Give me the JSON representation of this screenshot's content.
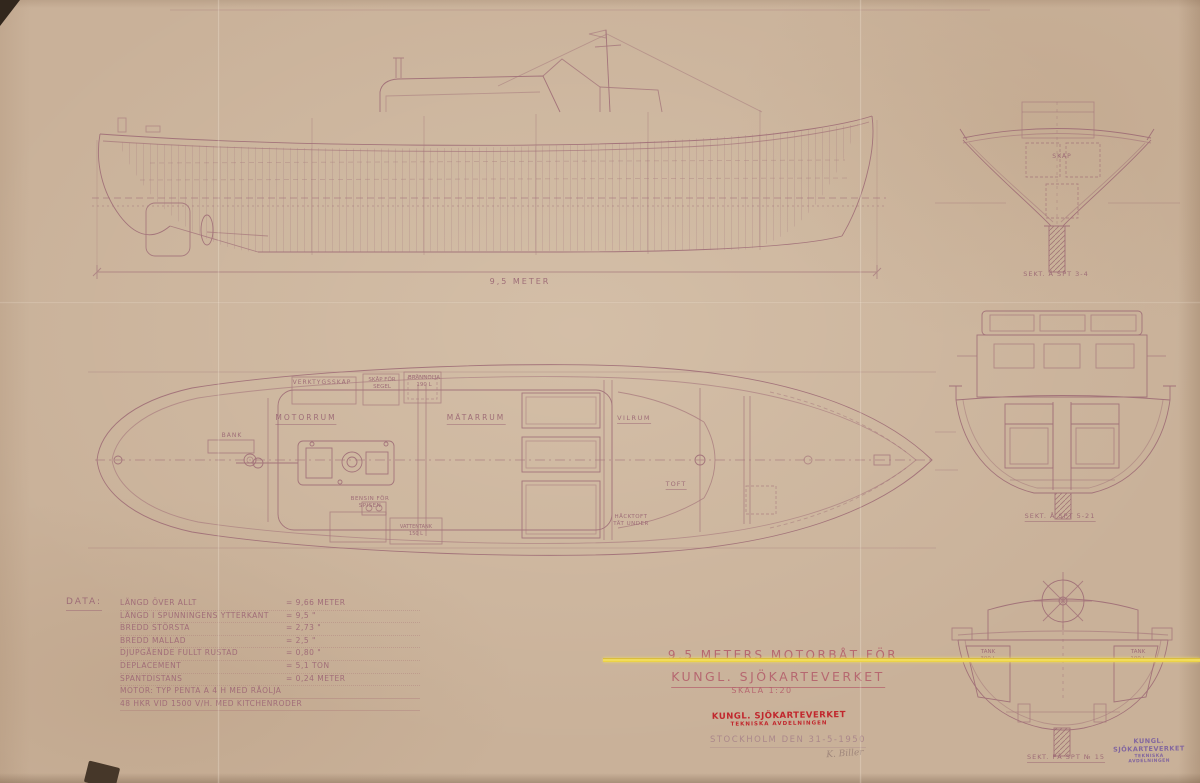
{
  "title_block": {
    "line1": "9,5 METERS MOTORBÅT FÖR",
    "line2": "KUNGL. SJÖKARTEVERKET",
    "scale": "SKALA 1:20"
  },
  "date_line": "STOCKHOLM DEN 31-5-1950",
  "signature": "K. Biller",
  "stamp_center": {
    "line1": "KUNGL. SJÖKARTEVERKET",
    "line2": "TEKNISKA AVDELNINGEN"
  },
  "stamp_corner": {
    "line1": "KUNGL. SJÖKARTEVERKET",
    "line2": "TEKNISKA AVDELNINGEN"
  },
  "data_table": {
    "heading": "DATA:",
    "rows": [
      {
        "label": "LÄNGD ÖVER ALLT",
        "value": "= 9,66 METER"
      },
      {
        "label": "LÄNGD I SPUNNINGENS YTTERKANT",
        "value": "= 9,5  \""
      },
      {
        "label": "BREDD STÖRSTA",
        "value": "= 2,73  \""
      },
      {
        "label": "BREDD MALLAD",
        "value": "= 2,5  \""
      },
      {
        "label": "DJUPGÅENDE FULLT RUSTAD",
        "value": "= 0,80  \""
      },
      {
        "label": "DEPLACEMENT",
        "value": "= 5,1 TON"
      },
      {
        "label": "SPANTDISTANS",
        "value": "= 0,24 METER"
      }
    ],
    "motor_line1": "MOTOR: TYP PENTA A 4 H MED RÅOLJA",
    "motor_line2": "48 HKR VID 1500 V/H. MED KITCHENRODER"
  },
  "profile_view": {
    "dimension_label": "9,5 METER"
  },
  "plan_view": {
    "labels": {
      "verktygsskap": "VERKTYGSSKÅP",
      "skap_for_segel": "SKÅP FÖR\nSEGEL",
      "brannolja": "BRÄNNOLJA\n190 L",
      "motorrum": "MOTORRUM",
      "matarrum": "MÄTARRUM",
      "vilrum": "VILRUM",
      "bank": "BÄNK",
      "toft": "TOFT",
      "hacktoft": "HÄCKTOFT\nTÄT UNDER",
      "bensin": "BENSIN FÖR\nSPISEN",
      "vattentank": "VATTENTANK\n150 L"
    }
  },
  "sections": {
    "bow": {
      "caption": "SEKT. Å SPT 3-4",
      "label_skap": "SKÅP"
    },
    "mid": {
      "caption": "SEKT. Å SPT 5-21"
    },
    "stern": {
      "caption": "SEKT. PÅ SPT № 15",
      "tank_left": "TANK\n300 L",
      "tank_right": "TANK\n100 L"
    }
  },
  "colors": {
    "paper": "#c9b199",
    "ink": "#9c6874",
    "stamp_red": "#c1272d",
    "stamp_purple": "#7a5fa0",
    "highlight_yellow": "#f0da4e"
  }
}
